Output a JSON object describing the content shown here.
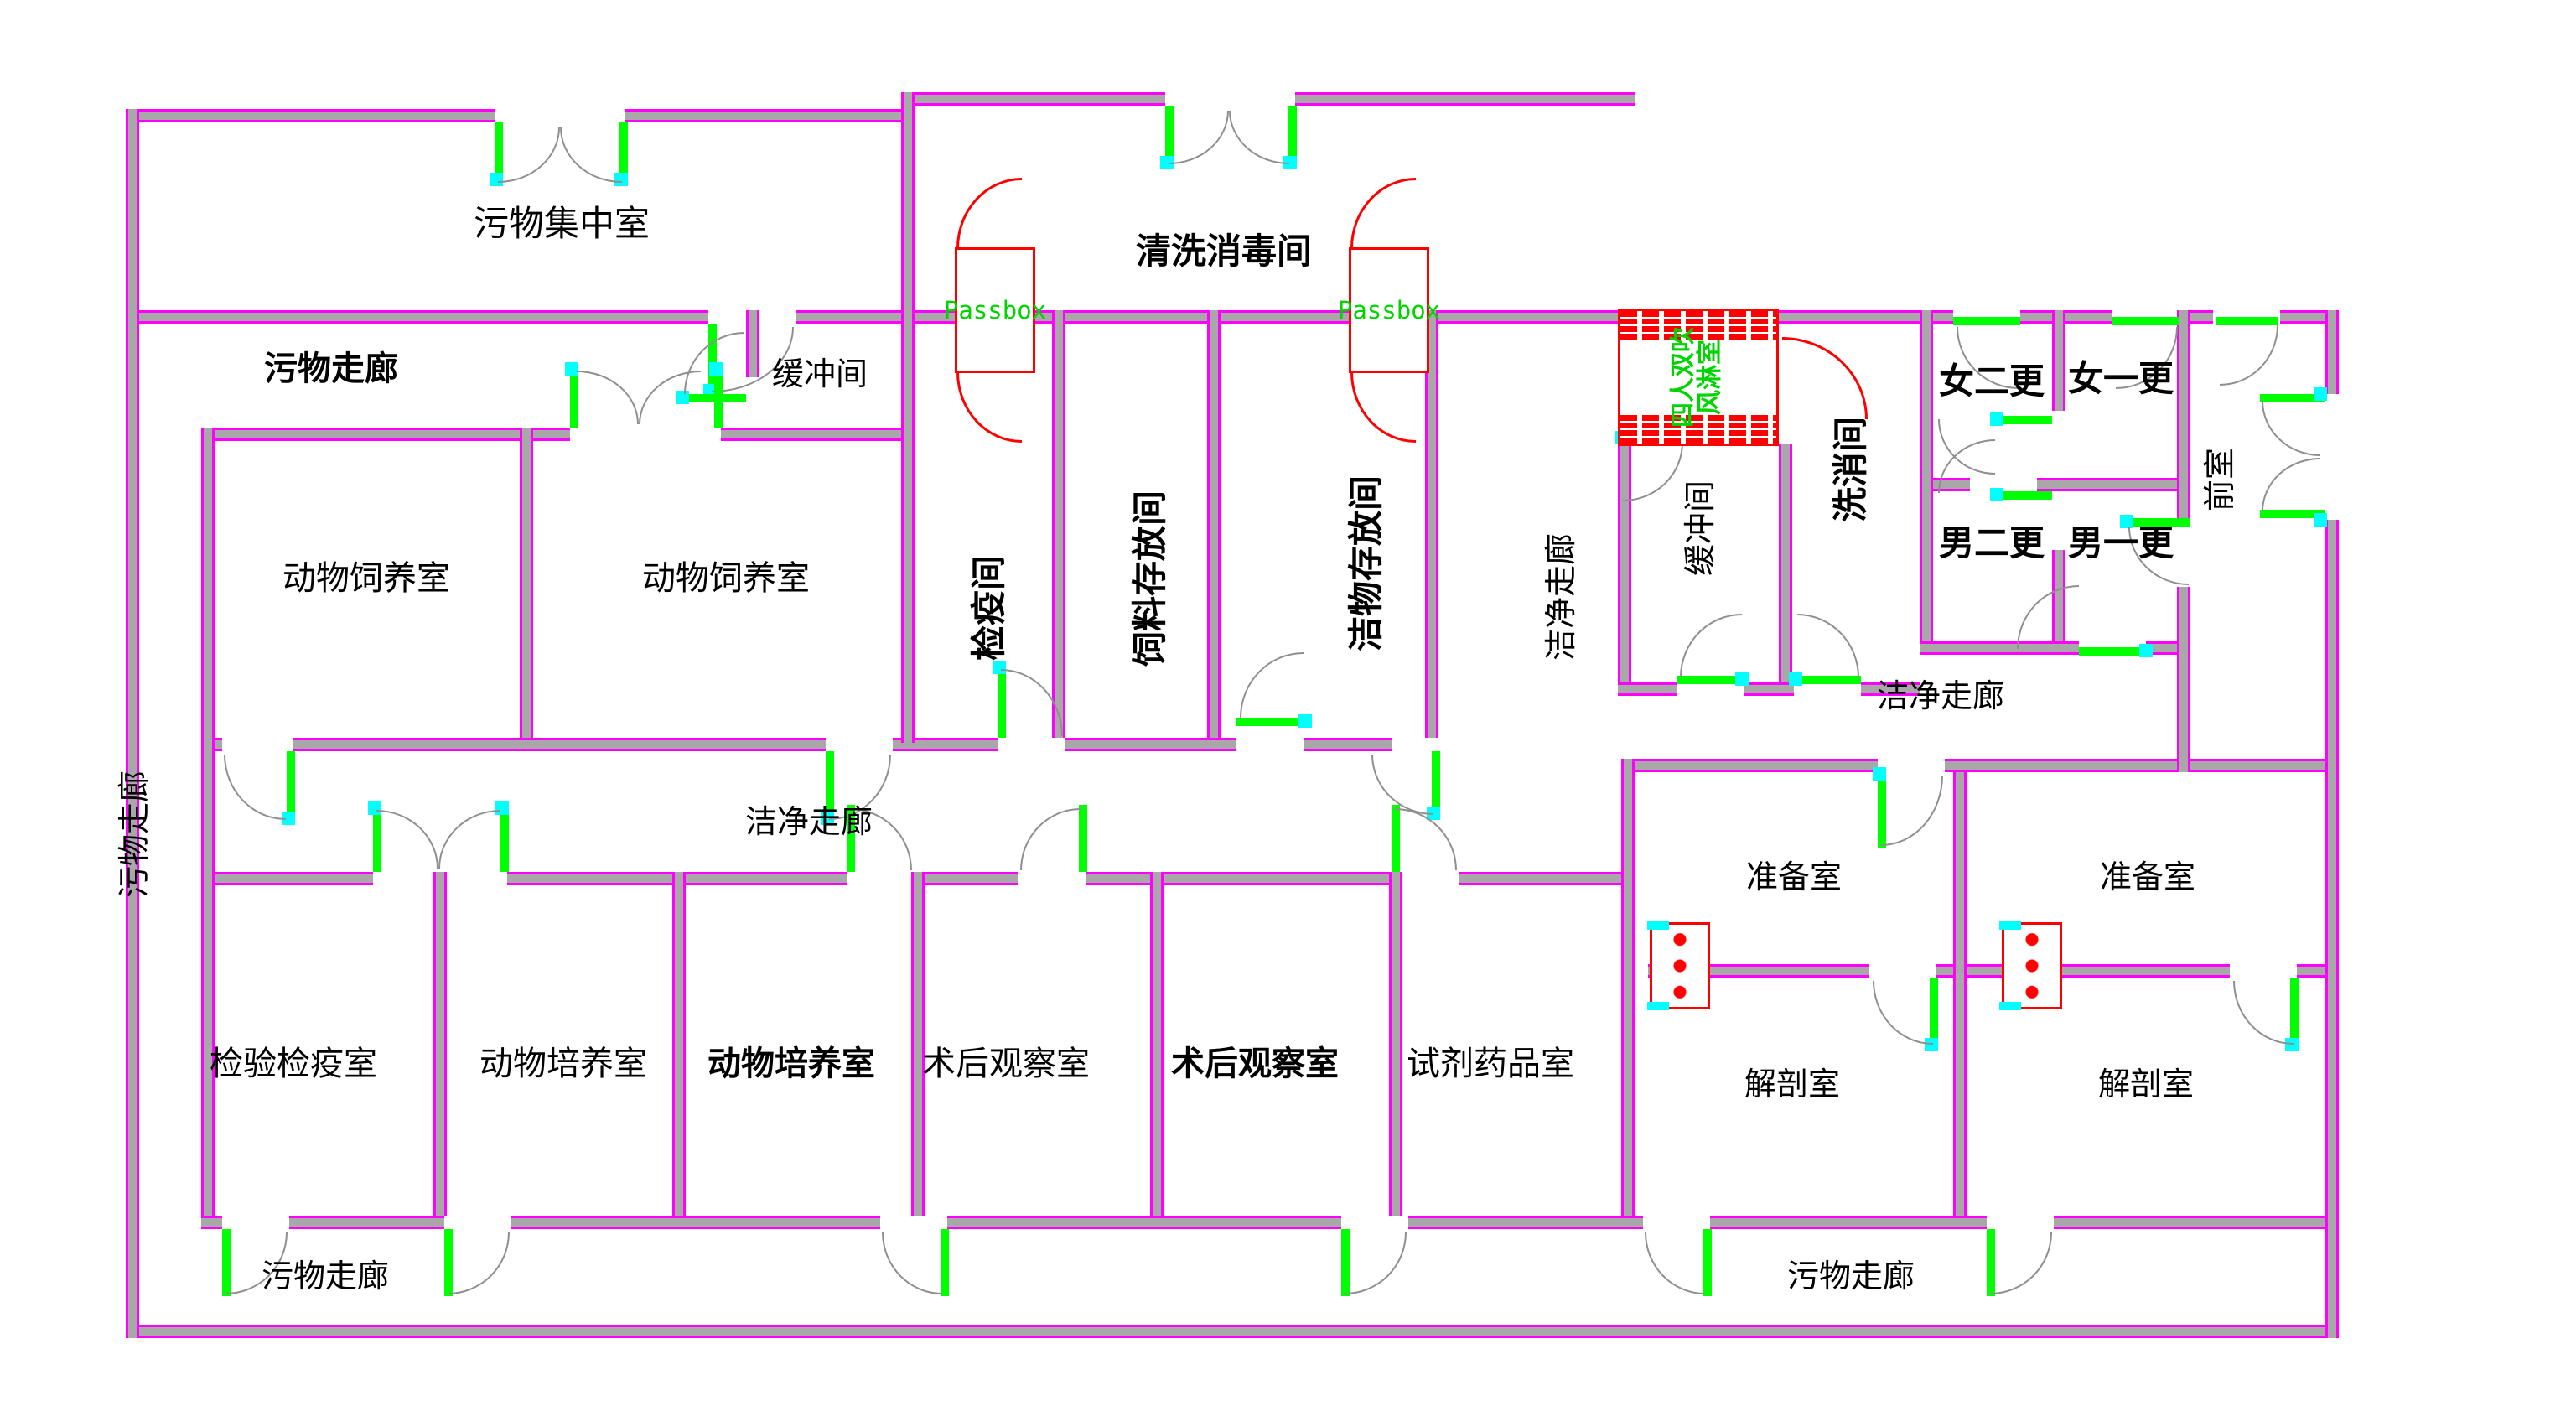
{
  "colors": {
    "wall_edge": "#ff00ff",
    "wall_core": "#a8a8a8",
    "door_leaf": "#00ff00",
    "door_hinge": "#00ffff",
    "symbol_red": "#ff0000",
    "green_text": "#00d400"
  },
  "labels": {
    "waste_collection": "污物集中室",
    "wash_disinfect": "清洗消毒间",
    "waste_corridor_top": "污物走廊",
    "buffer_top": "缓冲间",
    "animal_feeding_1": "动物饲养室",
    "animal_feeding_2": "动物饲养室",
    "waste_corridor_left": "污物走廊",
    "quarantine": "检疫间",
    "feed_storage": "饲料存放间",
    "clean_storage": "洁物存放间",
    "clean_corridor_mid_v": "洁净走廊",
    "buffer_right": "缓冲间",
    "wash_room": "洗消间",
    "female_change_2": "女二更",
    "female_change_1": "女一更",
    "male_change_2": "男二更",
    "male_change_1": "男一更",
    "front_room": "前室",
    "clean_corridor_right": "洁净走廊",
    "clean_corridor_mid": "洁净走廊",
    "prep_room_1": "准备室",
    "prep_room_2": "准备室",
    "dissection_1": "解剖室",
    "dissection_2": "解剖室",
    "inspection_quarantine": "检验检疫室",
    "animal_culture_1": "动物培养室",
    "animal_culture_2": "动物培养室",
    "postop_observe_1": "术后观察室",
    "postop_observe_2": "术后观察室",
    "reagent_drug": "试剂药品室",
    "waste_corridor_bottom_left": "污物走廊",
    "waste_corridor_bottom_right": "污物走廊"
  },
  "passbox": {
    "label": "Passbox"
  },
  "air_shower": {
    "line1": "四人双吹",
    "line2": "风淋室"
  }
}
